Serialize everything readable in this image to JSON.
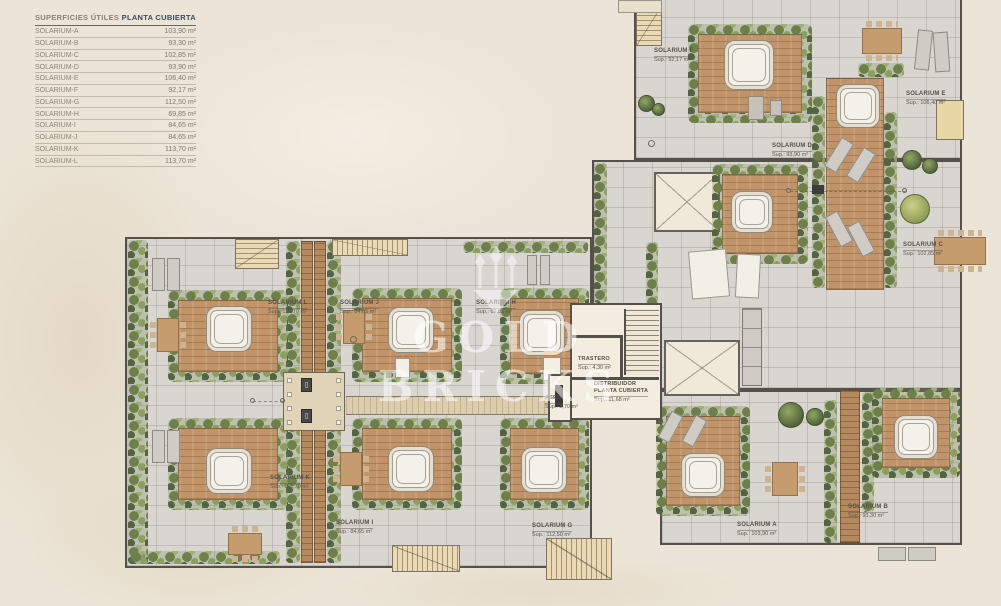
{
  "legend": {
    "title": "SUPERFICIES ÚTILES",
    "plan_name": "PLANTA CUBIERTA",
    "rows": [
      {
        "label": "SOLARIUM-A",
        "value": "103,90 m²"
      },
      {
        "label": "SOLARIUM-B",
        "value": "93,30 m²"
      },
      {
        "label": "SOLARIUM-C",
        "value": "102,85 m²"
      },
      {
        "label": "SOLARIUM-D",
        "value": "93,90 m²"
      },
      {
        "label": "SOLARIUM-E",
        "value": "106,40 m²"
      },
      {
        "label": "SOLARIUM-F",
        "value": "92,17 m²"
      },
      {
        "label": "SOLARIUM-G",
        "value": "112,50 m²"
      },
      {
        "label": "SOLARIUM-H",
        "value": "69,85 m²"
      },
      {
        "label": "SOLARIUM-I",
        "value": "84,65 m²"
      },
      {
        "label": "SOLARIUM-J",
        "value": "84,65 m²"
      },
      {
        "label": "SOLARIUM-K",
        "value": "113,70 m²"
      },
      {
        "label": "SOLARIUM-L",
        "value": "113,70 m²"
      }
    ]
  },
  "watermark": {
    "text": "GOLD BRICKS"
  },
  "plan": {
    "area_labels": [
      {
        "name": "SOLARIUM L",
        "sup": "Sup.: 113,70 m²",
        "x": 268,
        "y": 291
      },
      {
        "name": "SOLARIUM J",
        "sup": "Sup.: 84,65 m²",
        "x": 340,
        "y": 291
      },
      {
        "name": "SOLARIUM H",
        "sup": "Sup.: 69,85 m²",
        "x": 476,
        "y": 291
      },
      {
        "name": "SOLARIUM K",
        "sup": "Sup.: 113,70 m²",
        "x": 270,
        "y": 466
      },
      {
        "name": "SOLARIUM I",
        "sup": "Sup.: 84,65 m²",
        "x": 336,
        "y": 511
      },
      {
        "name": "SOLARIUM G",
        "sup": "Sup.: 112,50 m²",
        "x": 532,
        "y": 514
      },
      {
        "name": "SOLARIUM A",
        "sup": "Sup.: 103,90 m²",
        "x": 737,
        "y": 513
      },
      {
        "name": "SOLARIUM B",
        "sup": "Sup.: 93,30 m²",
        "x": 848,
        "y": 495
      },
      {
        "name": "SOLARIUM F",
        "sup": "Sup.: 92,17 m²",
        "x": 654,
        "y": 39
      },
      {
        "name": "SOLARIUM E",
        "sup": "Sup.: 106,40 m²",
        "x": 906,
        "y": 82
      },
      {
        "name": "SOLARIUM D",
        "sup": "Sup.: 93,90 m²",
        "x": 772,
        "y": 134
      },
      {
        "name": "SOLARIUM C",
        "sup": "Sup.: 102,85 m²",
        "x": 903,
        "y": 233
      }
    ],
    "room_labels": [
      {
        "name": "TRASTERO",
        "sup": "Sup.: 4,30 m²",
        "x": 578,
        "y": 347
      },
      {
        "name": "DISTRIBUIDOR\nPLANTA CUBIERTA",
        "sup": "Sup.: 11,68 m²",
        "x": 594,
        "y": 379
      },
      {
        "name": "ASEO",
        "sup": "Sup.: 2,70 m²",
        "x": 545,
        "y": 386
      }
    ]
  }
}
